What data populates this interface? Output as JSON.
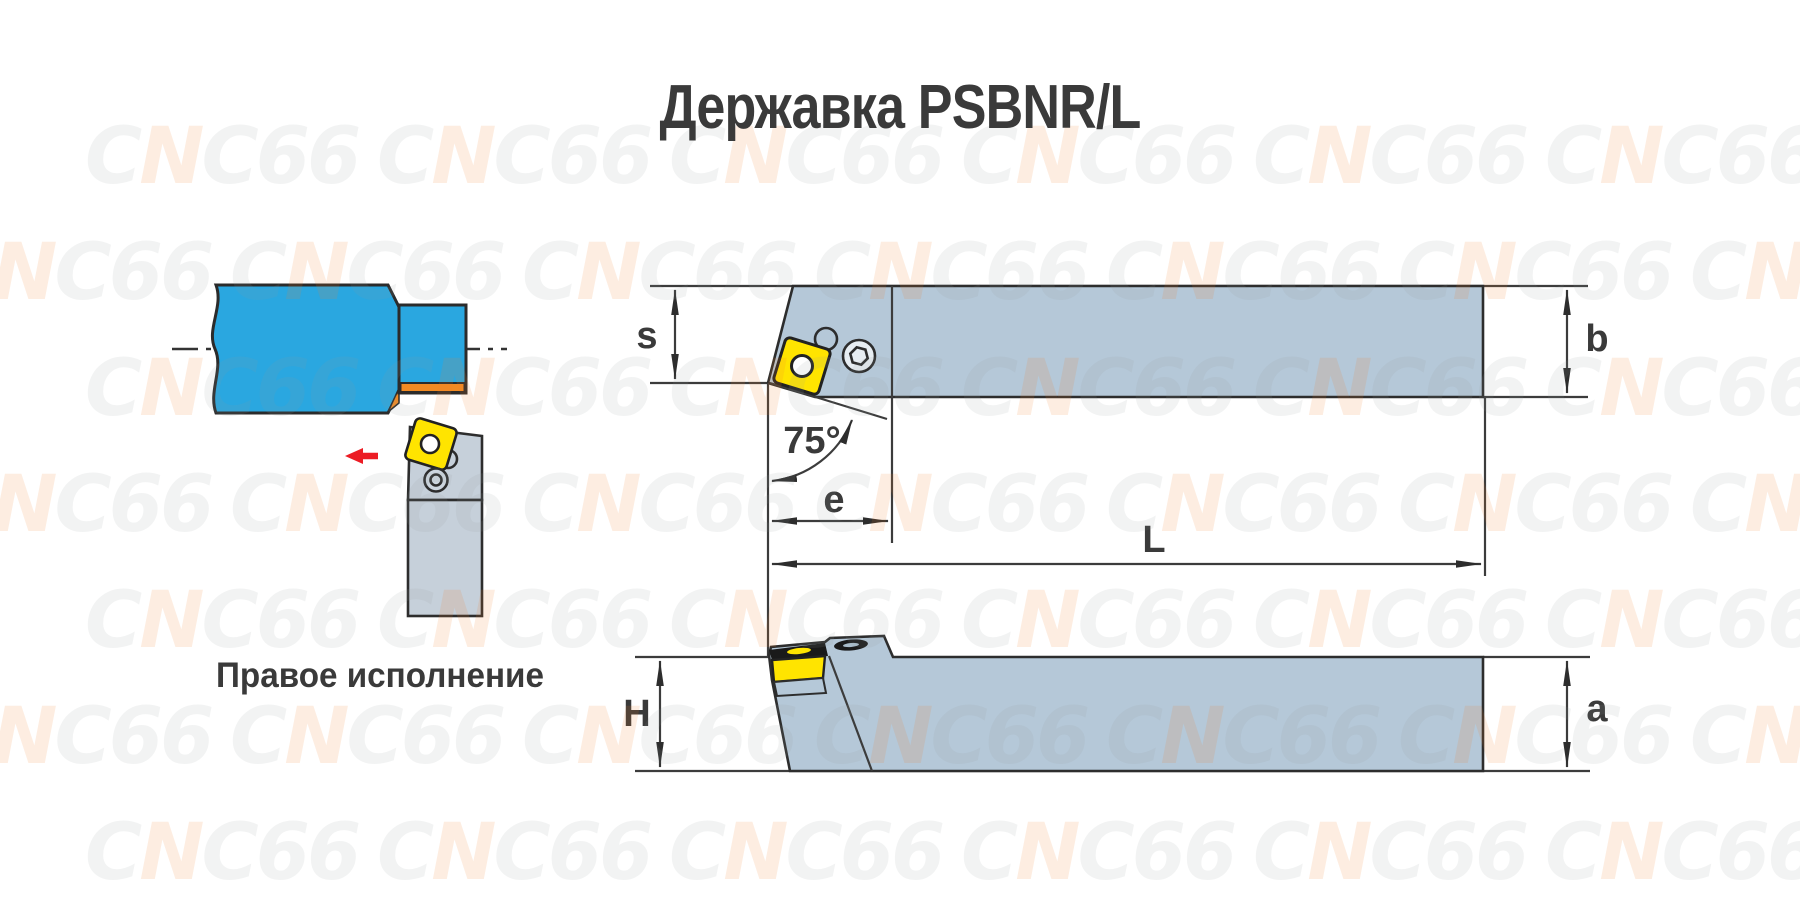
{
  "title": "Державка PSBNR/L",
  "watermark": {
    "text": "CNC66"
  },
  "left_illustration": {
    "caption": "Правое исполнение",
    "colors": {
      "workpiece_blue": "#2AA7E0",
      "machined_orange": "#F18A23",
      "insert_yellow": "#FFE400",
      "holder_gray": "#C6D0DA",
      "screw_gray": "#CDD6DF",
      "feed_arrow_red": "#EC1C24"
    }
  },
  "drawings": {
    "body_gray": "#B5C8D8",
    "screw_face": "#E7EDF2",
    "dark_detail": "#1A1A1A",
    "dims": {
      "s": "s",
      "b": "b",
      "e": "e",
      "L": "L",
      "H": "H",
      "a": "a",
      "angle": "75°"
    }
  }
}
